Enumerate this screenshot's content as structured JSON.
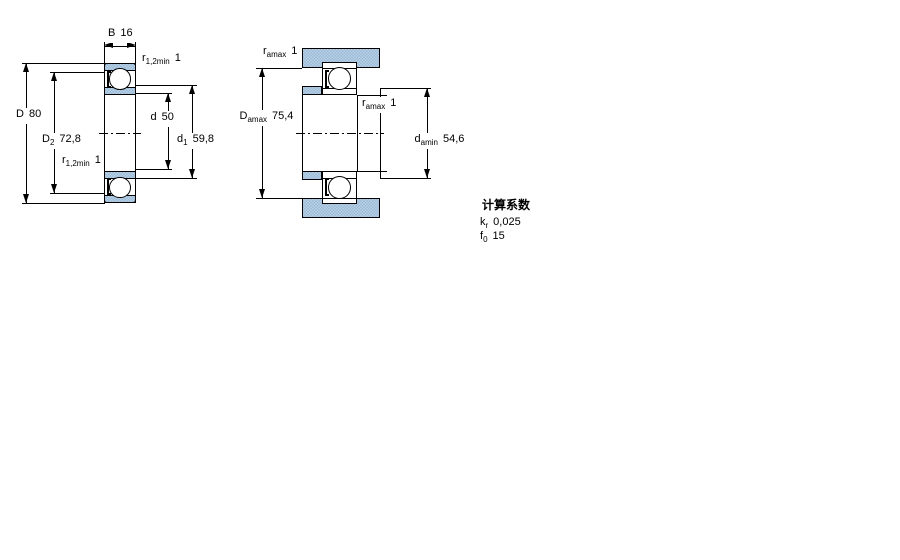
{
  "left_view": {
    "description": "bearing cross-section with boundary dimensions",
    "dims": [
      {
        "main": "B",
        "sub": "",
        "value": "16"
      },
      {
        "main": "r",
        "sub": "1,2min",
        "value": "1"
      },
      {
        "main": "D",
        "sub": "",
        "value": "80"
      },
      {
        "main": "D",
        "sub": "2",
        "value": "72,8"
      },
      {
        "main": "r",
        "sub": "1,2min",
        "value": "1"
      },
      {
        "main": "d",
        "sub": "",
        "value": "50"
      },
      {
        "main": "d",
        "sub": "1",
        "value": "59,8"
      }
    ]
  },
  "right_view": {
    "description": "bearing mounted with shaft/housing abutment dimensions",
    "dims": [
      {
        "main": "r",
        "sub": "amax",
        "value": "1"
      },
      {
        "main": "D",
        "sub": "amax",
        "value": "75,4"
      },
      {
        "main": "r",
        "sub": "amax",
        "value": "1"
      },
      {
        "main": "d",
        "sub": "amin",
        "value": "54,6"
      }
    ]
  },
  "factors": {
    "title": "计算系数",
    "rows": [
      {
        "main": "k",
        "sub": "r",
        "value": "0,025"
      },
      {
        "main": "f",
        "sub": "0",
        "value": "15"
      }
    ]
  },
  "colors": {
    "section_fill": "#a9c5df",
    "line": "#000000",
    "background": "#ffffff"
  }
}
